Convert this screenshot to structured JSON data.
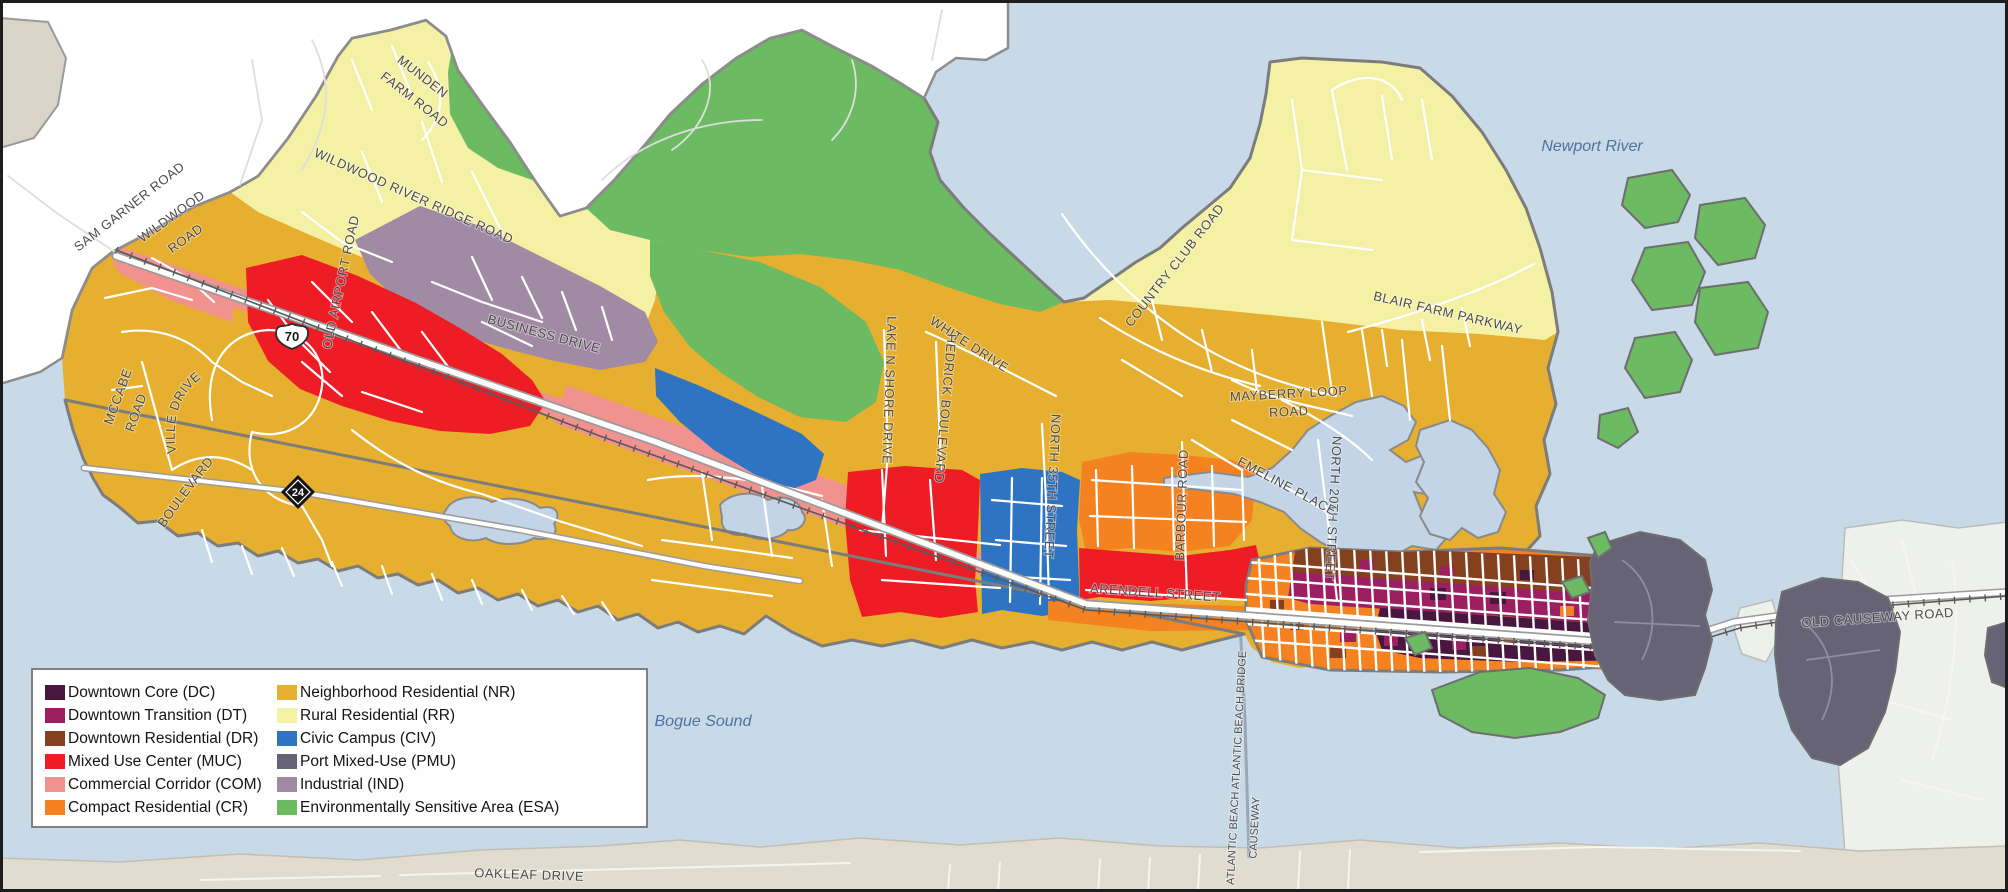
{
  "legend": {
    "items": [
      {
        "label": "Downtown Core (DC)",
        "color": "#47173f"
      },
      {
        "label": "Downtown Transition (DT)",
        "color": "#9d1f63"
      },
      {
        "label": "Downtown Residential (DR)",
        "color": "#84401f"
      },
      {
        "label": "Mixed Use Center (MUC)",
        "color": "#ee1c25"
      },
      {
        "label": "Commercial Corridor (COM)",
        "color": "#f2928e"
      },
      {
        "label": "Compact Residential (CR)",
        "color": "#f58220"
      },
      {
        "label": "Neighborhood Residential (NR)",
        "color": "#e7af2f"
      },
      {
        "label": "Rural Residential (RR)",
        "color": "#f4f0a4"
      },
      {
        "label": "Civic Campus (CIV)",
        "color": "#2e74c2"
      },
      {
        "label": "Port Mixed-Use (PMU)",
        "color": "#666377"
      },
      {
        "label": "Industrial (IND)",
        "color": "#a18ba4"
      },
      {
        "label": "Environmentally Sensitive Area (ESA)",
        "color": "#6cba62"
      }
    ]
  },
  "map": {
    "water": {
      "newport": "Newport River",
      "bogue": "Bogue Sound"
    },
    "shields": {
      "us70": "70",
      "nc24": "24"
    },
    "roads": {
      "munden1": "MUNDEN",
      "munden2": "FARM ROAD",
      "wildwood_river": "WILDWOOD RIVER RIDGE ROAD",
      "sam_garner": "SAM GARNER ROAD",
      "wildwood1": "WILDWOOD",
      "wildwood2": "ROAD",
      "old_airport": "OLD AIRPORT ROAD",
      "business": "BUSINESS DRIVE",
      "lord_granville": "LORD GRANVILLE DRIVE",
      "mccabe1": "MCCABE",
      "mccabe2": "ROAD",
      "brandywine": "BRANDYWINE BOULEVARD",
      "lake_n_shore": "LAKE N SHORE DRIVE",
      "white_drive": "WHITE DRIVE",
      "hedrick": "HEDRICK BOULEVARD",
      "north_35th": "NORTH 35TH STREET",
      "country_club": "COUNTRY CLUB ROAD",
      "mayberry1": "MAYBERRY LOOP",
      "mayberry2": "ROAD",
      "blair_farm": "BLAIR FARM PARKWAY",
      "north_20th": "NORTH 20TH STREET",
      "emeline": "EMELINE PLACE",
      "barbour": "BARBOUR ROAD",
      "arendell": "ARENDELL STREET",
      "ab_causeway1": "ATLANTIC BEACH ATLANTIC BEACH BRIDGE",
      "ab_causeway2": "CAUSEWAY",
      "old_causeway": "OLD CAUSEWAY ROAD",
      "oakleaf": "OAKLEAF DRIVE"
    }
  }
}
